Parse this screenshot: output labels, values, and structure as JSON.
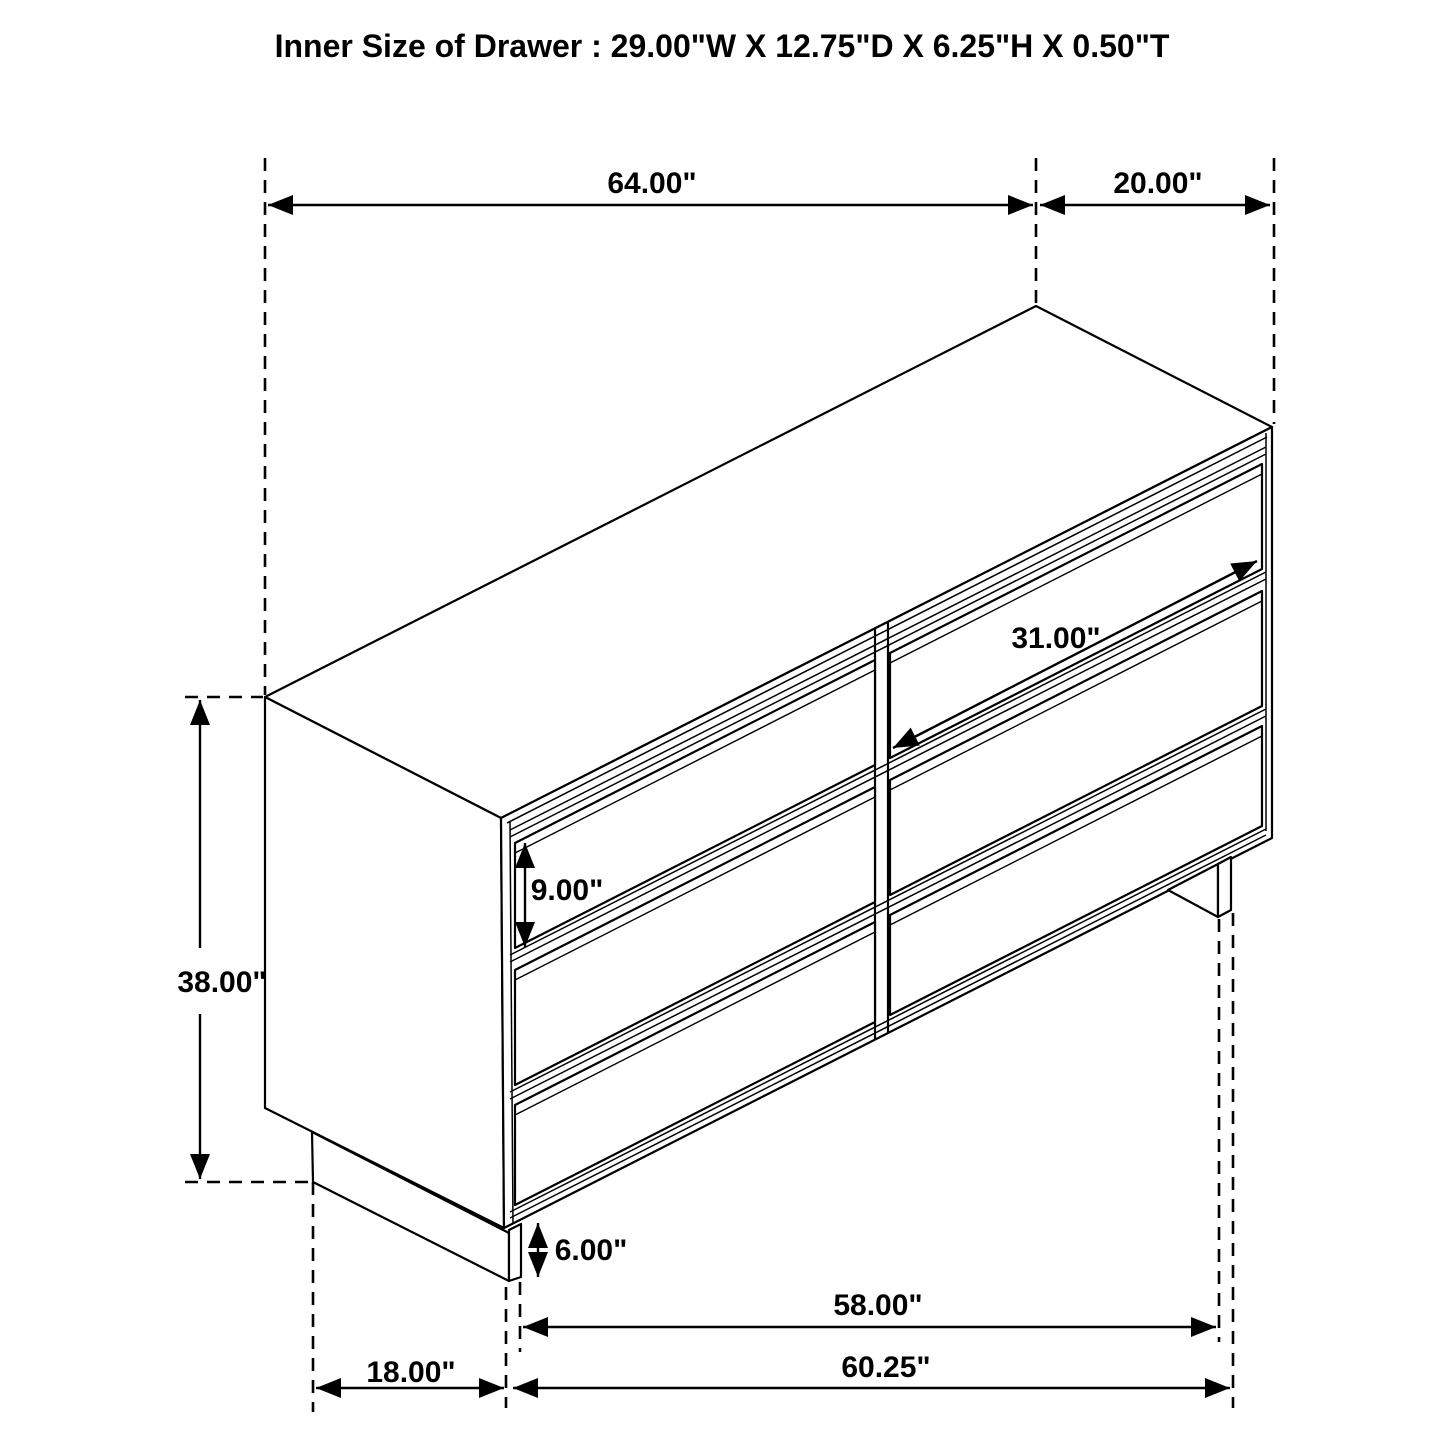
{
  "title": "Inner Size of Drawer : 29.00\"W X 12.75\"D X 6.25\"H X 0.50\"T",
  "drawing": {
    "kind": "dresser-six-drawer-isometric-line-drawing",
    "line_color": "#000000",
    "background_color": "#ffffff",
    "drawer_count": 6
  },
  "inner_drawer_size": {
    "width_in": 29.0,
    "depth_in": 12.75,
    "height_in": 6.25,
    "thickness_in": 0.5
  },
  "dimensions": [
    {
      "id": "top-width",
      "label": "64.00\"",
      "value": 64.0,
      "lx": 652,
      "ly": 193,
      "segments": [
        {
          "x1": 268,
          "y1": 205,
          "x2": 1033,
          "y2": 205,
          "a1": true,
          "a2": true
        }
      ]
    },
    {
      "id": "top-depth",
      "label": "20.00\"",
      "value": 20.0,
      "lx": 1158,
      "ly": 193,
      "segments": [
        {
          "x1": 1040,
          "y1": 205,
          "x2": 1270,
          "y2": 205,
          "a1": true,
          "a2": true
        }
      ]
    },
    {
      "id": "overall-height",
      "label": "38.00\"",
      "value": 38.0,
      "lx": 222,
      "ly": 992,
      "segments": [
        {
          "x1": 200,
          "y1": 700,
          "x2": 200,
          "y2": 948,
          "a1": true,
          "a2": false
        },
        {
          "x1": 200,
          "y1": 1014,
          "x2": 200,
          "y2": 1179,
          "a1": false,
          "a2": true
        }
      ]
    },
    {
      "id": "drawer-front-height",
      "label": "9.00\"",
      "value": 9.0,
      "lx": 567,
      "ly": 900,
      "segments": [
        {
          "x1": 525,
          "y1": 843,
          "x2": 525,
          "y2": 947,
          "a1": true,
          "a2": true
        }
      ]
    },
    {
      "id": "drawer-front-width",
      "label": "31.00\"",
      "value": 31.0,
      "lx": 1056,
      "ly": 648,
      "segments": [
        {
          "x1": 893,
          "y1": 748,
          "x2": 1257,
          "y2": 561,
          "a1": true,
          "a2": true
        }
      ]
    },
    {
      "id": "base-height",
      "label": "6.00\"",
      "value": 6.0,
      "lx": 591,
      "ly": 1260,
      "segments": [
        {
          "x1": 538,
          "y1": 1223,
          "x2": 538,
          "y2": 1277,
          "a1": true,
          "a2": true
        }
      ]
    },
    {
      "id": "base-width",
      "label": "58.00\"",
      "value": 58.0,
      "lx": 878,
      "ly": 1315,
      "segments": [
        {
          "x1": 523,
          "y1": 1327,
          "x2": 1216,
          "y2": 1327,
          "a1": true,
          "a2": true
        }
      ]
    },
    {
      "id": "bottom-width",
      "label": "60.25\"",
      "value": 60.25,
      "lx": 886,
      "ly": 1377,
      "segments": [
        {
          "x1": 513,
          "y1": 1388,
          "x2": 1230,
          "y2": 1388,
          "a1": true,
          "a2": true
        }
      ]
    },
    {
      "id": "base-depth",
      "label": "18.00\"",
      "value": 18.0,
      "lx": 411,
      "ly": 1382,
      "segments": [
        {
          "x1": 316,
          "y1": 1388,
          "x2": 504,
          "y2": 1388,
          "a1": true,
          "a2": true
        }
      ]
    }
  ]
}
